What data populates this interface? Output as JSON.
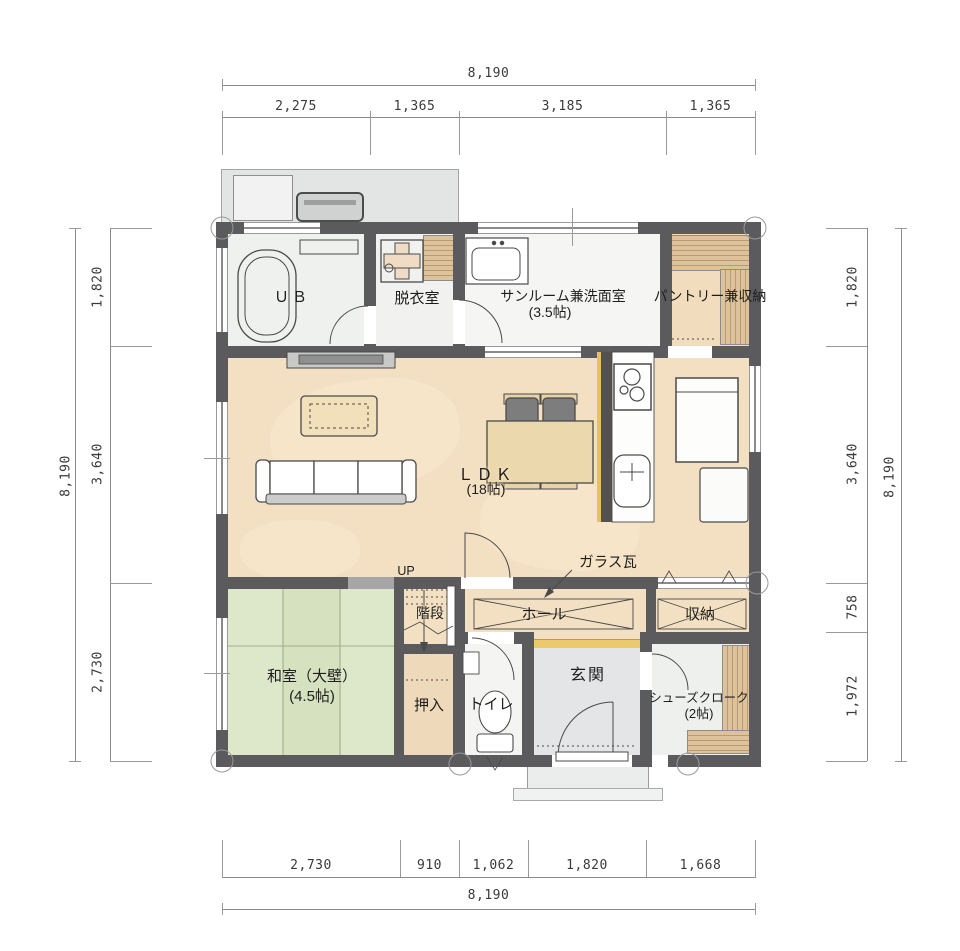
{
  "drawing": {
    "type": "floor-plan",
    "floor": "1F"
  },
  "dimensions": {
    "top": {
      "total": "8,190",
      "segments": [
        "2,275",
        "1,365",
        "3,185",
        "1,365"
      ]
    },
    "bottom": {
      "total": "8,190",
      "segments": [
        "2,730",
        "910",
        "1,062",
        "1,820",
        "1,668"
      ]
    },
    "left": {
      "total": "8,190",
      "segments": [
        "1,820",
        "3,640",
        "2,730"
      ]
    },
    "right": {
      "total": "8,190",
      "segments": [
        "1,820",
        "3,640",
        "758",
        "1,972"
      ]
    }
  },
  "rooms": {
    "ub": {
      "name": "ＵＢ"
    },
    "dressing": {
      "name": "脱衣室"
    },
    "sunroom": {
      "name": "サンルーム兼洗面室",
      "size": "(3.5帖)"
    },
    "pantry": {
      "name": "パントリー兼収納"
    },
    "ldk": {
      "name": "ＬＤＫ",
      "size": "(18帖)"
    },
    "hall": {
      "name": "ホール"
    },
    "stairs": {
      "name": "階段",
      "direction": "UP"
    },
    "storage": {
      "name": "収納"
    },
    "washitsu": {
      "name": "和室（大壁）",
      "size": "(4.5帖)"
    },
    "oshiire": {
      "name": "押入"
    },
    "toilet": {
      "name": "トイレ"
    },
    "genkan": {
      "name": "玄関"
    },
    "shoe_closet": {
      "name": "シューズクローク",
      "size": "(2帖)"
    }
  },
  "notes": {
    "glass_tile": "ガラス瓦"
  },
  "colors": {
    "wall": "#5b5a5d",
    "ldk_floor": "#f3dfc2",
    "tatami": "#dde7ca",
    "wet_area_floor": "#f2f3f1",
    "entry_tile": "#e4e5e7",
    "wood_shelf": "#dcc39b",
    "step_accent": "#ecc96d",
    "line": "#4a4a4a"
  }
}
